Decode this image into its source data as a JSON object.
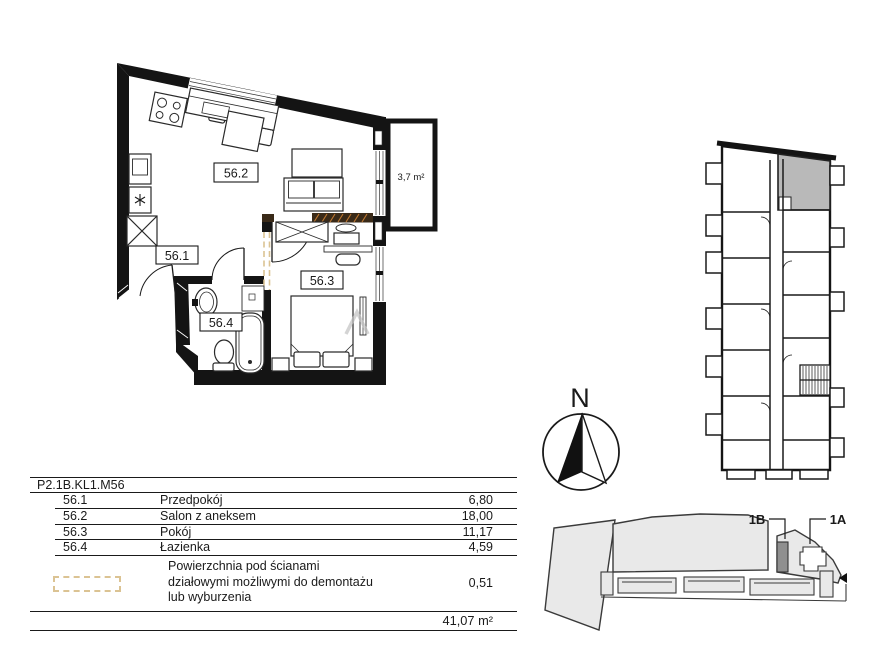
{
  "floor_plan": {
    "room_labels": {
      "hall": "56.1",
      "living": "56.2",
      "bedroom": "56.3",
      "bathroom": "56.4"
    },
    "balcony_area_label": "3,7 m²"
  },
  "compass": {
    "north_label": "N"
  },
  "site_plan": {
    "stair_b_label": "1B",
    "stair_a_label": "1A"
  },
  "area_table": {
    "apartment_code": "P2.1B.KL1.M56",
    "rows": [
      {
        "no": "56.1",
        "name": "Przedpokój",
        "area": "6,80"
      },
      {
        "no": "56.2",
        "name": "Salon z aneksem",
        "area": "18,00"
      },
      {
        "no": "56.3",
        "name": "Pokój",
        "area": "11,17"
      },
      {
        "no": "56.4",
        "name": "Łazienka",
        "area": "4,59"
      }
    ],
    "demolition_note": {
      "lines": [
        "Powierzchnia pod ścianami",
        "działowymi możliwymi do demontażu",
        "lub wyburzenia"
      ],
      "area": "0,51"
    },
    "total_area": "41,07 m²"
  },
  "icons": {
    "washer": "asterisk-icon",
    "north_arrow": "compass-needle-icon",
    "site_pointer": "left-arrow-icon"
  },
  "colors": {
    "wall": "#141414",
    "demountable_dash": "#dbc393",
    "demolition_strip": "#3a2a18",
    "demolition_hatch": "#c07830",
    "unit_highlight": "#b9b9b9",
    "site_fill": "#e9e9e9",
    "site_marker": "#8f8f8f"
  }
}
